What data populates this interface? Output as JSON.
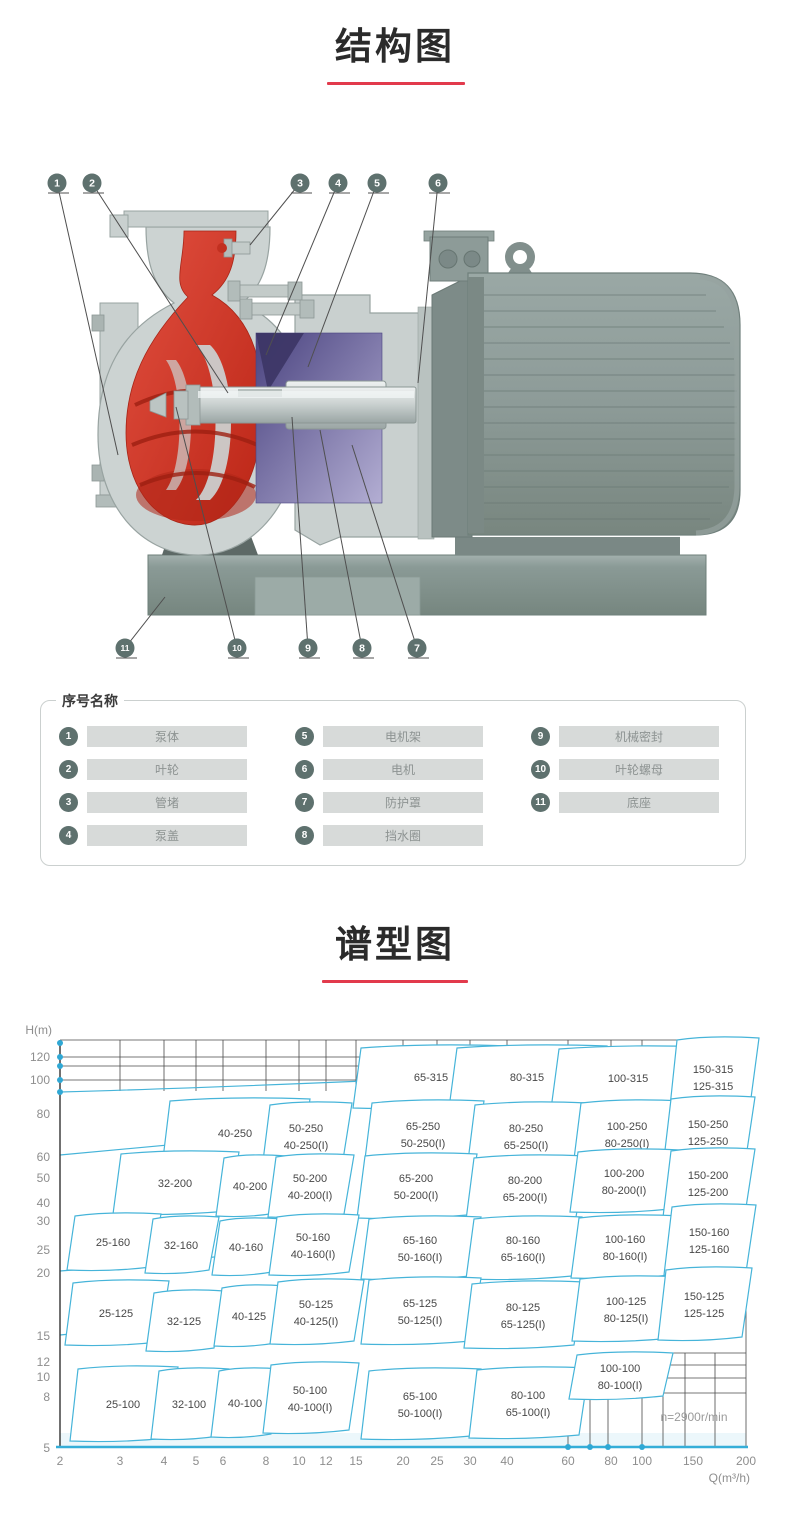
{
  "sections": {
    "structure": {
      "title": "结构图"
    },
    "spectrum": {
      "title": "谱型图"
    }
  },
  "accent": {
    "underline_color": "#e23a4c",
    "callout_color": "#5e716e",
    "cyan": "#46b4d9"
  },
  "diagram": {
    "callouts": [
      {
        "n": "1",
        "cx": 57,
        "cy": 38,
        "ex": 118,
        "ey": 310
      },
      {
        "n": "2",
        "cx": 92,
        "cy": 38,
        "ex": 228,
        "ey": 248
      },
      {
        "n": "3",
        "cx": 300,
        "cy": 38,
        "ex": 250,
        "ey": 100
      },
      {
        "n": "4",
        "cx": 338,
        "cy": 38,
        "ex": 266,
        "ey": 210
      },
      {
        "n": "5",
        "cx": 377,
        "cy": 38,
        "ex": 308,
        "ey": 222
      },
      {
        "n": "6",
        "cx": 438,
        "cy": 38,
        "ex": 418,
        "ey": 238
      },
      {
        "n": "7",
        "cx": 417,
        "cy": 503,
        "ex": 352,
        "ey": 300
      },
      {
        "n": "8",
        "cx": 362,
        "cy": 503,
        "ex": 320,
        "ey": 285
      },
      {
        "n": "9",
        "cx": 308,
        "cy": 503,
        "ex": 292,
        "ey": 272
      },
      {
        "n": "10",
        "cx": 237,
        "cy": 503,
        "ex": 176,
        "ey": 262
      },
      {
        "n": "11",
        "cx": 125,
        "cy": 503,
        "ex": 165,
        "ey": 452
      }
    ]
  },
  "parts_legend": {
    "title": "序号名称",
    "items": [
      {
        "num": "1",
        "label": "泵体"
      },
      {
        "num": "2",
        "label": "叶轮"
      },
      {
        "num": "3",
        "label": "管堵"
      },
      {
        "num": "4",
        "label": "泵盖"
      },
      {
        "num": "5",
        "label": "电机架"
      },
      {
        "num": "6",
        "label": "电机"
      },
      {
        "num": "7",
        "label": "防护罩"
      },
      {
        "num": "8",
        "label": "挡水圈"
      },
      {
        "num": "9",
        "label": "机械密封"
      },
      {
        "num": "10",
        "label": "叶轮螺母"
      },
      {
        "num": "11",
        "label": "底座"
      }
    ]
  },
  "chart_data": {
    "type": "area",
    "title": "谱型图",
    "xlabel": "Q(m³/h)",
    "ylabel": "H(m)",
    "x_scale": "log",
    "y_scale": "log",
    "xlim": [
      2,
      200
    ],
    "ylim": [
      5,
      130
    ],
    "note": "n=2900r/min",
    "note_pos": [
      694,
      406
    ],
    "x_ticks_px": [
      [
        "2",
        60
      ],
      [
        "3",
        120
      ],
      [
        "4",
        164
      ],
      [
        "5",
        196
      ],
      [
        "6",
        223
      ],
      [
        "8",
        266
      ],
      [
        "10",
        299
      ],
      [
        "12",
        326
      ],
      [
        "15",
        356
      ],
      [
        "20",
        403
      ],
      [
        "25",
        437
      ],
      [
        "30",
        470
      ],
      [
        "40",
        507
      ],
      [
        "60",
        568
      ],
      [
        "80",
        611
      ],
      [
        "100",
        642
      ],
      [
        "150",
        693
      ],
      [
        "200",
        746
      ]
    ],
    "y_ticks_px": [
      [
        "120",
        42
      ],
      [
        "100",
        65
      ],
      [
        "80",
        99
      ],
      [
        "60",
        142
      ],
      [
        "50",
        163
      ],
      [
        "40",
        188
      ],
      [
        "30",
        206
      ],
      [
        "25",
        235
      ],
      [
        "20",
        258
      ],
      [
        "15",
        321
      ],
      [
        "12",
        347
      ],
      [
        "10",
        362
      ],
      [
        "8",
        382
      ],
      [
        "5",
        433
      ]
    ],
    "regions": [
      {
        "labels": [
          "65-315"
        ],
        "cx": 428,
        "cy": 62,
        "w": 150,
        "h": 62
      },
      {
        "labels": [
          "80-315"
        ],
        "cx": 524,
        "cy": 62,
        "w": 150,
        "h": 62
      },
      {
        "labels": [
          "100-315"
        ],
        "cx": 625,
        "cy": 63,
        "w": 148,
        "h": 62
      },
      {
        "labels": [
          "150-315",
          "125-315"
        ],
        "cx": 710,
        "cy": 62,
        "w": 82,
        "h": 78
      },
      {
        "labels": [
          "40-250"
        ],
        "cx": 232,
        "cy": 118,
        "w": 140,
        "h": 68
      },
      {
        "labels": [
          "50-250",
          "40-250(I)"
        ],
        "cx": 303,
        "cy": 121,
        "w": 82,
        "h": 66
      },
      {
        "labels": [
          "65-250",
          "50-250(I)"
        ],
        "cx": 420,
        "cy": 119,
        "w": 112,
        "h": 66
      },
      {
        "labels": [
          "80-250",
          "65-250(I)"
        ],
        "cx": 523,
        "cy": 121,
        "w": 112,
        "h": 66
      },
      {
        "labels": [
          "100-250",
          "80-250(I)"
        ],
        "cx": 624,
        "cy": 119,
        "w": 102,
        "h": 66
      },
      {
        "labels": [
          "150-250",
          "125-250"
        ],
        "cx": 705,
        "cy": 117,
        "w": 84,
        "h": 70
      },
      {
        "labels": [
          "32-200"
        ],
        "cx": 172,
        "cy": 168,
        "w": 118,
        "h": 62
      },
      {
        "labels": [
          "40-200"
        ],
        "cx": 247,
        "cy": 171,
        "w": 62,
        "h": 60
      },
      {
        "labels": [
          "50-200",
          "40-200(I)"
        ],
        "cx": 307,
        "cy": 171,
        "w": 78,
        "h": 62
      },
      {
        "labels": [
          "65-200",
          "50-200(I)"
        ],
        "cx": 413,
        "cy": 171,
        "w": 112,
        "h": 64
      },
      {
        "labels": [
          "80-200",
          "65-200(I)"
        ],
        "cx": 522,
        "cy": 173,
        "w": 112,
        "h": 64
      },
      {
        "labels": [
          "100-200",
          "80-200(I)"
        ],
        "cx": 621,
        "cy": 166,
        "w": 102,
        "h": 62
      },
      {
        "labels": [
          "150-200",
          "125-200"
        ],
        "cx": 705,
        "cy": 168,
        "w": 84,
        "h": 68
      },
      {
        "labels": [
          "25-160"
        ],
        "cx": 110,
        "cy": 227,
        "w": 86,
        "h": 56
      },
      {
        "labels": [
          "32-160"
        ],
        "cx": 178,
        "cy": 230,
        "w": 66,
        "h": 56
      },
      {
        "labels": [
          "40-160"
        ],
        "cx": 243,
        "cy": 232,
        "w": 62,
        "h": 56
      },
      {
        "labels": [
          "50-160",
          "40-160(I)"
        ],
        "cx": 310,
        "cy": 230,
        "w": 82,
        "h": 60
      },
      {
        "labels": [
          "65-160",
          "50-160(I)"
        ],
        "cx": 417,
        "cy": 233,
        "w": 112,
        "h": 62
      },
      {
        "labels": [
          "80-160",
          "65-160(I)"
        ],
        "cx": 520,
        "cy": 233,
        "w": 108,
        "h": 62
      },
      {
        "labels": [
          "100-160",
          "80-160(I)"
        ],
        "cx": 622,
        "cy": 232,
        "w": 102,
        "h": 62
      },
      {
        "labels": [
          "150-160",
          "125-160"
        ],
        "cx": 706,
        "cy": 225,
        "w": 84,
        "h": 70
      },
      {
        "labels": [
          "25-125"
        ],
        "cx": 113,
        "cy": 298,
        "w": 96,
        "h": 64
      },
      {
        "labels": [
          "32-125"
        ],
        "cx": 181,
        "cy": 306,
        "w": 70,
        "h": 60
      },
      {
        "labels": [
          "40-125"
        ],
        "cx": 246,
        "cy": 301,
        "w": 64,
        "h": 60
      },
      {
        "labels": [
          "50-125",
          "40-125(I)"
        ],
        "cx": 313,
        "cy": 297,
        "w": 86,
        "h": 64
      },
      {
        "labels": [
          "65-125",
          "50-125(I)"
        ],
        "cx": 417,
        "cy": 296,
        "w": 112,
        "h": 66
      },
      {
        "labels": [
          "80-125",
          "65-125(I)"
        ],
        "cx": 520,
        "cy": 300,
        "w": 112,
        "h": 66
      },
      {
        "labels": [
          "100-125",
          "80-125(I)"
        ],
        "cx": 623,
        "cy": 294,
        "w": 102,
        "h": 64
      },
      {
        "labels": [
          "150-125",
          "125-125"
        ],
        "cx": 701,
        "cy": 289,
        "w": 86,
        "h": 72
      },
      {
        "labels": [
          "25-100"
        ],
        "cx": 120,
        "cy": 389,
        "w": 100,
        "h": 74
      },
      {
        "labels": [
          "32-100"
        ],
        "cx": 186,
        "cy": 389,
        "w": 70,
        "h": 70
      },
      {
        "labels": [
          "40-100"
        ],
        "cx": 242,
        "cy": 388,
        "w": 62,
        "h": 68
      },
      {
        "labels": [
          "50-100",
          "40-100(I)"
        ],
        "cx": 307,
        "cy": 383,
        "w": 88,
        "h": 70
      },
      {
        "labels": [
          "65-100",
          "50-100(I)"
        ],
        "cx": 417,
        "cy": 389,
        "w": 112,
        "h": 70
      },
      {
        "labels": [
          "80-100",
          "65-100(I)"
        ],
        "cx": 525,
        "cy": 388,
        "w": 112,
        "h": 70
      },
      {
        "labels": [
          "100-100",
          "80-100(I)"
        ],
        "cx": 617,
        "cy": 361,
        "w": 96,
        "h": 46
      }
    ],
    "dots": {
      "left_axis_y": [
        28,
        42,
        51,
        65,
        77
      ],
      "bottom_axis_x": [
        568,
        590,
        608,
        642
      ]
    },
    "grid2": [
      [
        568,
        378,
        568,
        432
      ],
      [
        590,
        378,
        590,
        432
      ],
      [
        608,
        378,
        608,
        432
      ],
      [
        642,
        363,
        642,
        432
      ],
      [
        663,
        338,
        663,
        432
      ],
      [
        685,
        338,
        685,
        432
      ],
      [
        715,
        338,
        715,
        432
      ],
      [
        642,
        338,
        746,
        338
      ],
      [
        642,
        350,
        746,
        350
      ],
      [
        630,
        363,
        746,
        363
      ],
      [
        530,
        378,
        746,
        378
      ]
    ]
  }
}
